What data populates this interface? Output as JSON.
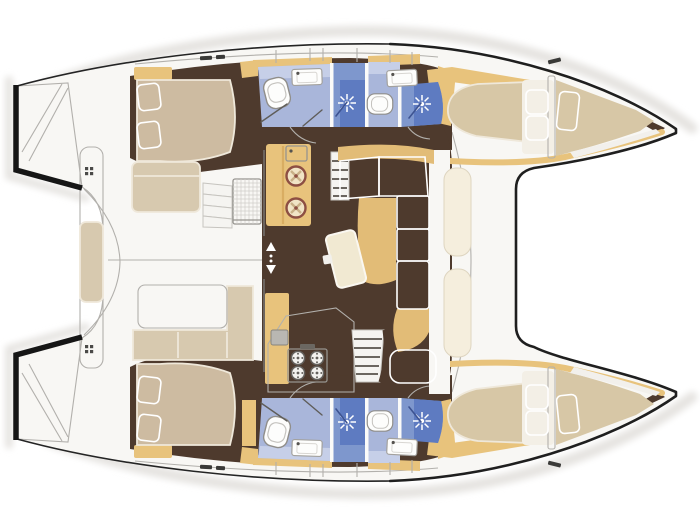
{
  "image": {
    "type": "boat-floor-plan",
    "subject": "top-down interior layout plan of a sailing catamaran, bows to the right, sterns to the left",
    "width": 700,
    "height": 525,
    "visible_text": []
  },
  "colors": {
    "background": "#ffffff",
    "outline": "#242424",
    "deck_white": "#f8f7f4",
    "line_gray": "#b2b0ac",
    "shadow_gray": "#e6e4e1",
    "floor_brown": "#4e3a2d",
    "wood_tan": "#e8c37c",
    "wood_tan_deep": "#d9ad62",
    "mattress_beige": "#cdbba1",
    "mattress_khaki": "#d7c7a6",
    "pillow_cream": "#ebe2cf",
    "underlay_white": "#f3efe6",
    "sofa_cream": "#f3ecda",
    "sofa_tan": "#e2bc77",
    "table_cream": "#f1e9d2",
    "pad_cream": "#f5eedd",
    "bench_beige": "#d7c9af",
    "bath_blue_light": "#c6cfe8",
    "bath_blue": "#a9b6da",
    "shower_blue": "#7e97cd",
    "shower_blue_deep": "#5e7bc1",
    "fixture_white": "#fdfdfc",
    "steel_gray": "#b9b7b2",
    "stove_ring": "#8d4f43"
  },
  "icons": {
    "toilet": "toilet-icon",
    "sink": "sink-icon",
    "shower_spray": "shower-spray-icon",
    "stove_burner": "stove-burner-icon",
    "cleat": "cleat-icon",
    "door_arrows": "sliding-door-arrows-icon"
  },
  "layout": {
    "hulls": [
      {
        "side": "port-top",
        "rooms": [
          "aft-double-cabin",
          "head-with-shower",
          "second-head-with-shower",
          "forward-double-cabin",
          "forepeak-berth"
        ]
      },
      {
        "side": "starboard-bottom",
        "rooms": [
          "aft-double-cabin",
          "head-with-shower",
          "second-head-with-shower",
          "forward-double-cabin",
          "forepeak-berth"
        ]
      }
    ],
    "bridge_deck": {
      "salon": [
        "galley-counter-two-burners",
        "sink-appliance",
        "port-companionway-stairs",
        "l-shaped-sofa",
        "chaise",
        "tilted-coffee-table",
        "four-burner-stove-counter",
        "gray-sink",
        "starboard-companionway-stairs",
        "sliding-door"
      ],
      "cockpit": [
        "aft-bench-bar-with-cushion",
        "top-bench",
        "entry-steps",
        "slatted-table",
        "white-table",
        "l-shaped-bench"
      ],
      "foredeck": [
        "trampoline-area",
        "two-sun-pads"
      ]
    },
    "counts": {
      "cabins": 4,
      "heads": 4,
      "shower_stalls": 4,
      "berth_pillata": 6
    }
  }
}
